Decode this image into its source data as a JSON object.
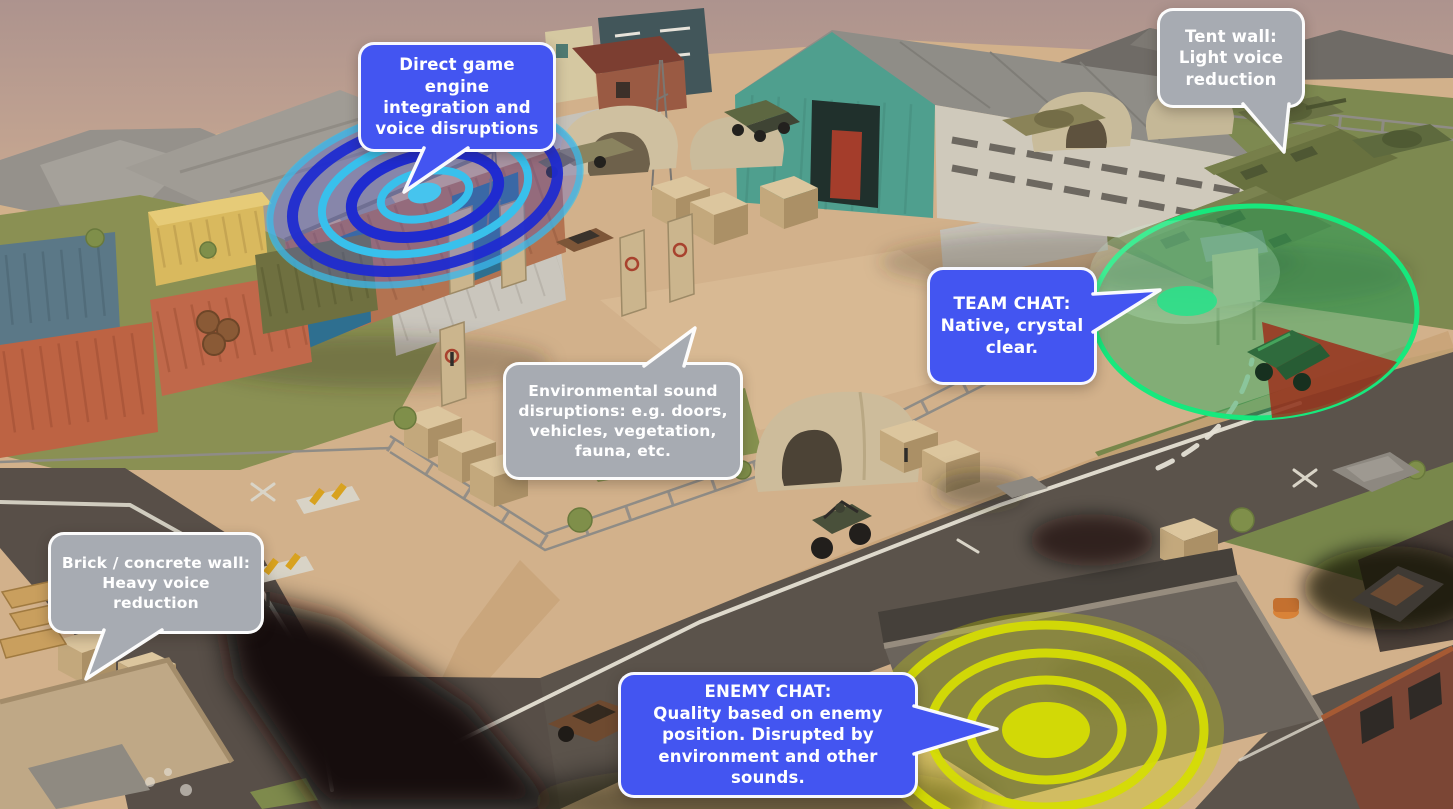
{
  "callouts": {
    "engine": {
      "style": "blue",
      "text": "Direct game engine\nintegration and\nvoice disruptions"
    },
    "tent_wall": {
      "style": "gray",
      "text": "Tent wall:\nLight voice\nreduction"
    },
    "team_chat": {
      "style": "blue",
      "text": "TEAM CHAT:\nNative, crystal\nclear."
    },
    "environment": {
      "style": "gray",
      "text": "Environmental sound\ndisruptions: e.g. doors,\nvehicles, vegetation,\nfauna, etc."
    },
    "brick_wall": {
      "style": "gray",
      "text": "Brick / concrete wall:\nHeavy voice\nreduction"
    },
    "enemy_chat": {
      "style": "blue",
      "text": "ENEMY CHAT:\nQuality based on enemy\nposition. Disrupted by\nenvironment and other sounds."
    }
  },
  "effects": {
    "voice_wave": {
      "name": "voice-disruption-waves",
      "ring_dark": "#1f2bd0",
      "ring_light": "#38c0ec",
      "source_dot": "#46c4ee"
    },
    "team_zone": {
      "name": "team-chat-zone",
      "ring": "#17e87d",
      "fill": "rgba(34,168,94,0.46)",
      "red_wedge": "rgba(158,44,26,0.82)"
    },
    "enemy_rings": {
      "name": "enemy-chat-rings",
      "ring": "#d5dc04",
      "fill": "rgba(208,214,2,0.30)"
    }
  },
  "colors": {
    "bubble_blue": "#4355f1",
    "bubble_gray": "#a7abb2",
    "bubble_border": "#ffffff",
    "bubble_text": "#ffffff"
  }
}
